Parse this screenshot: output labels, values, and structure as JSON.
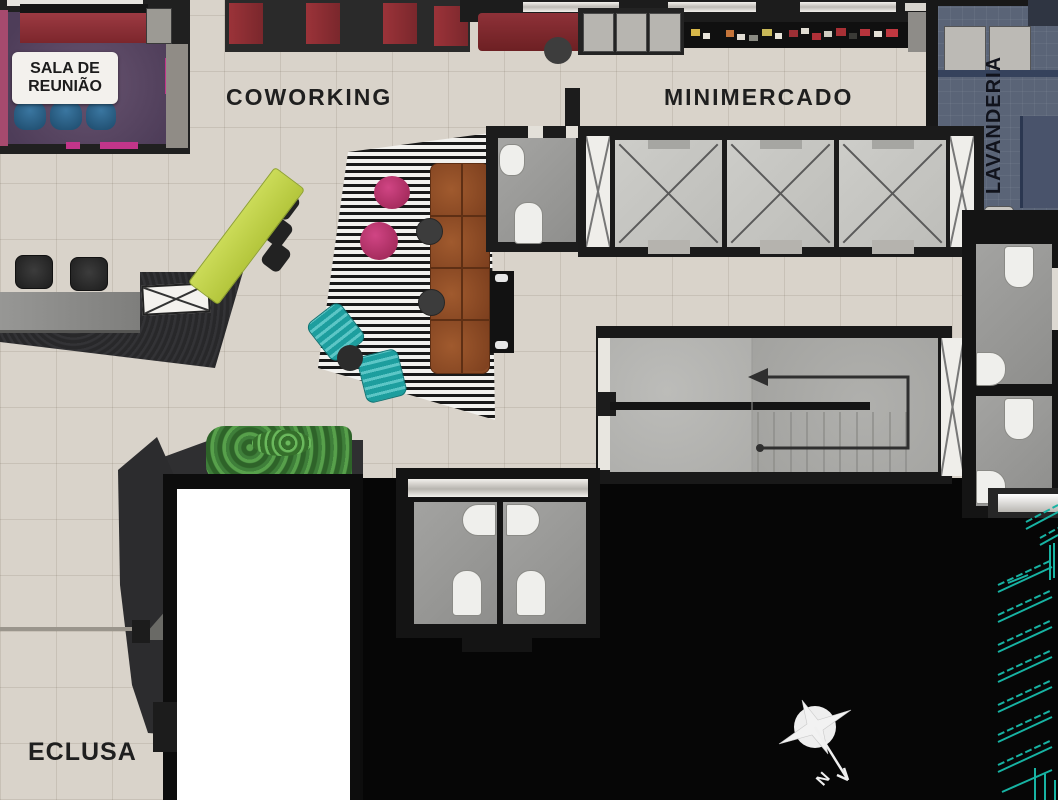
{
  "plan_title": "residential common-area floor plan",
  "rooms": {
    "sala_line1": "SALA DE",
    "sala_line2": "REUNIÃO",
    "coworking": "COWORKING",
    "minimercado": "MINIMERCADO",
    "lavanderia": "LAVANDERIA",
    "eclusa": "ECLUSA"
  },
  "compass": {
    "label": "N"
  },
  "palette": {
    "beige_floor": "#d9d3ca",
    "wall_black": "#1c1c1c",
    "void_black": "#060606",
    "purple_floor": "#5d4a68",
    "laundry_blue": "#5a6477",
    "booth_red": "#8e3038",
    "counter_maroon": "#7c2628",
    "table_lime": "#c3d44c",
    "chair_teal": "#1d9e9e",
    "pouf_magenta": "#c02d6c",
    "sofa_brown": "#8a4a25",
    "ramp_teal": "#17b3a3",
    "meeting_chair_blue": "#2a6088"
  }
}
